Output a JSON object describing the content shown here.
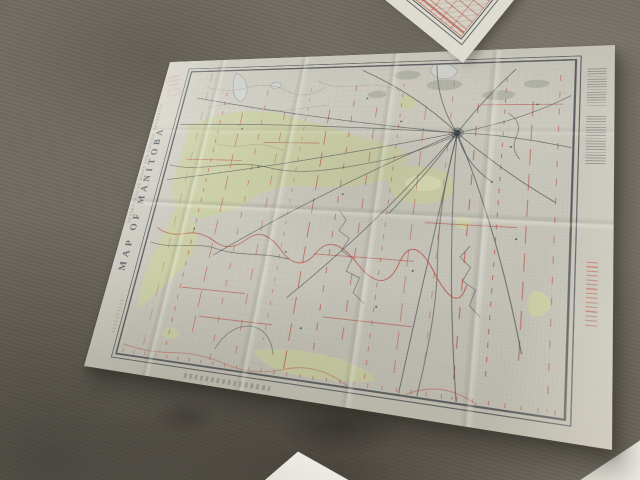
{
  "floor": {
    "color": "#716c62"
  },
  "main_map": {
    "title": "MAP OF MANITOBA",
    "imprint": "DEPARTMENT OF MINES AND NATURAL RESOURCES",
    "colors": {
      "paper": "#cfccc1",
      "highlight_region": "#cbcfa0",
      "survey_red": "#b5443c",
      "ink": "#42474d",
      "township_grid": "#8d96a1"
    },
    "graphics": {
      "red_line_xs": [
        64,
        90,
        116,
        142,
        168,
        194,
        220,
        246,
        272,
        298,
        324,
        350,
        376,
        402,
        428,
        452
      ],
      "red_dashes": [
        "12 16",
        "5 8",
        "18 10",
        "7 13"
      ],
      "red_h_segments": [
        [
          58,
          142,
          128
        ],
        [
          150,
          118,
          215
        ],
        [
          230,
          250,
          330
        ],
        [
          92,
          300,
          165
        ],
        [
          336,
          208,
          420
        ],
        [
          250,
          316,
          335
        ],
        [
          380,
          70,
          455
        ],
        [
          120,
          330,
          200
        ]
      ],
      "rail_hub": {
        "x": 358,
        "y": 104
      },
      "rail_endpoints": [
        [
          38,
          94
        ],
        [
          52,
          56
        ],
        [
          250,
          22
        ],
        [
          330,
          18
        ],
        [
          410,
          26
        ],
        [
          462,
          60
        ],
        [
          464,
          120
        ],
        [
          452,
          180
        ],
        [
          430,
          330
        ],
        [
          380,
          382
        ],
        [
          330,
          382
        ],
        [
          210,
          300
        ],
        [
          120,
          260
        ],
        [
          40,
          170
        ],
        [
          300,
          200
        ],
        [
          395,
          160
        ]
      ],
      "town_dots": [
        [
          150,
          150
        ],
        [
          200,
          250
        ],
        [
          250,
          180
        ],
        [
          300,
          90
        ],
        [
          120,
          100
        ],
        [
          90,
          230
        ],
        [
          395,
          160
        ],
        [
          420,
          220
        ],
        [
          300,
          300
        ],
        [
          230,
          330
        ],
        [
          180,
          80
        ],
        [
          260,
          60
        ],
        [
          410,
          120
        ],
        [
          330,
          260
        ],
        [
          432,
          70
        ]
      ],
      "bottom_ticks": {
        "y": 375,
        "x_start": 42,
        "x_end": 460,
        "step": 13
      }
    }
  }
}
